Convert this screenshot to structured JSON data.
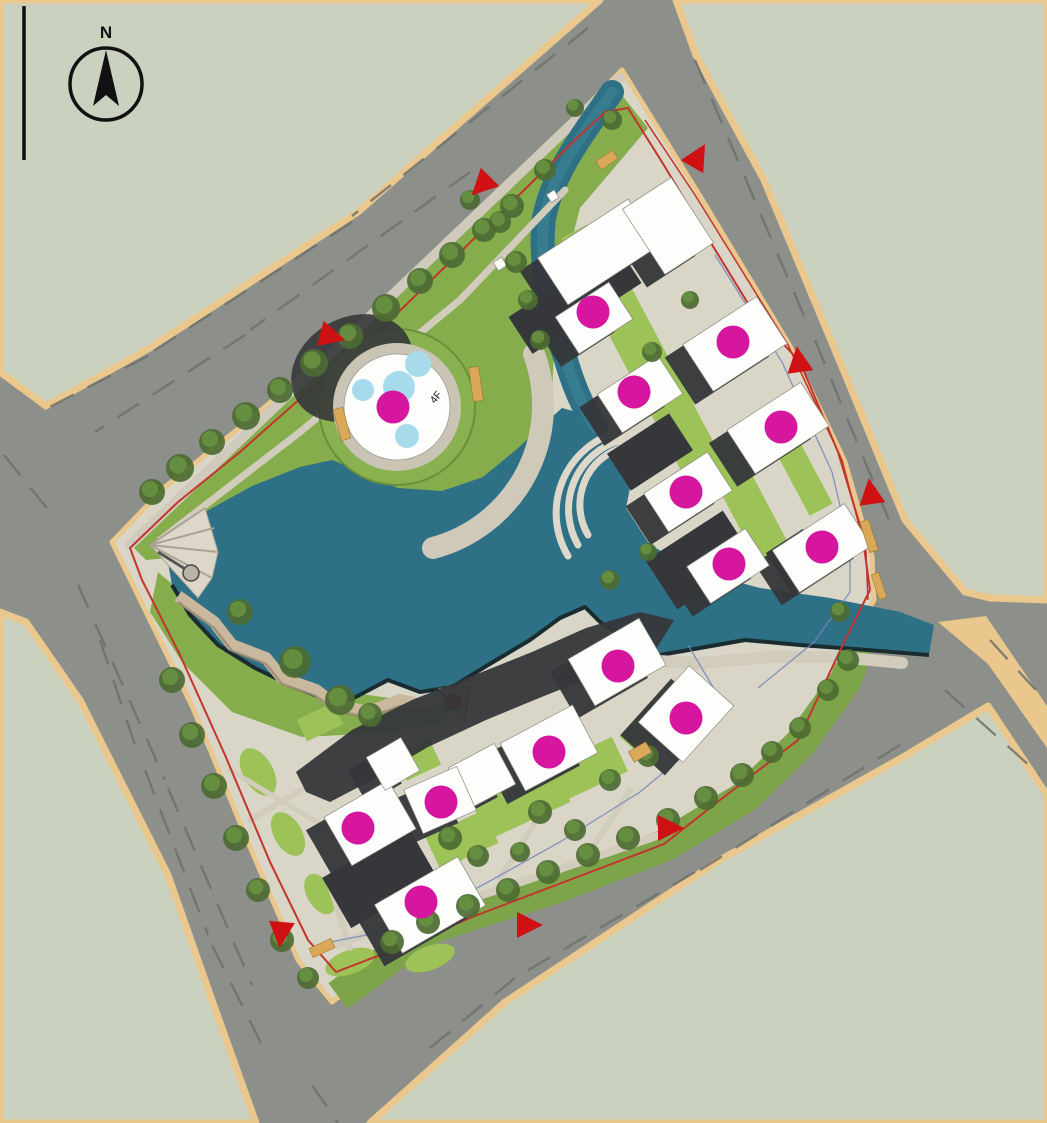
{
  "compass": {
    "label": "N"
  },
  "plaza": {
    "floor_label": "4F",
    "cx": 397,
    "cy": 407,
    "pools": [
      {
        "x": 418,
        "y": 364,
        "r": 13
      },
      {
        "x": 399,
        "y": 387,
        "r": 16
      },
      {
        "x": 363,
        "y": 390,
        "r": 11
      },
      {
        "x": 407,
        "y": 436,
        "r": 12
      }
    ]
  },
  "colors": {
    "road": "#8d8f8a",
    "road_dash": "#6e716c",
    "block": "#cbd1bf",
    "block_edge": "#e9c78d",
    "pavement": "#d9d5c7",
    "lawn": "#86ad4c",
    "lawn_light": "#9cc258",
    "lawn_band": "#7ea449",
    "tree_dark": "#4c6b33",
    "tree_mid": "#678f40",
    "lake": "#2e7086",
    "lake_edge": "#1b2c31",
    "pool": "#a7dbeb",
    "white": "#fdfdfb",
    "shadow": "#35373a",
    "magenta": "#d6169e",
    "red": "#cf1113",
    "red_line": "#c2342c",
    "blue_line": "#7186bb",
    "bench": "#d9a858",
    "terrace": "#c9b79e",
    "deck_red": "#c52020"
  },
  "markers": {
    "residential_units": [
      [
        593,
        312
      ],
      [
        733,
        342
      ],
      [
        634,
        392
      ],
      [
        781,
        427
      ],
      [
        686,
        492
      ],
      [
        729,
        564
      ],
      [
        822,
        547
      ],
      [
        393,
        407
      ],
      [
        618,
        666
      ],
      [
        686,
        718
      ],
      [
        549,
        752
      ],
      [
        441,
        802
      ],
      [
        358,
        828
      ],
      [
        421,
        902
      ]
    ],
    "entrances": [
      {
        "x": 483,
        "y": 184,
        "rot": 225
      },
      {
        "x": 697,
        "y": 158,
        "rot": 30
      },
      {
        "x": 330,
        "y": 336,
        "rot": 105
      },
      {
        "x": 799,
        "y": 362,
        "rot": -8
      },
      {
        "x": 871,
        "y": 494,
        "rot": -8
      },
      {
        "x": 668,
        "y": 828,
        "rot": 90
      },
      {
        "x": 527,
        "y": 925,
        "rot": 90
      },
      {
        "x": 281,
        "y": 932,
        "rot": 185
      }
    ]
  },
  "buildings": [
    [
      575,
      300,
      130,
      44,
      -33,
      "dark"
    ],
    [
      650,
      452,
      74,
      44,
      -33,
      "dark"
    ],
    [
      700,
      560,
      92,
      58,
      -33,
      "dark"
    ],
    [
      798,
      562,
      44,
      50,
      -33,
      "dark"
    ],
    [
      598,
      252,
      108,
      56,
      -33,
      "white"
    ],
    [
      668,
      226,
      58,
      78,
      -33,
      "white"
    ],
    [
      594,
      318,
      64,
      44,
      -33,
      "white"
    ],
    [
      735,
      344,
      88,
      56,
      -33,
      "white"
    ],
    [
      640,
      394,
      72,
      46,
      -33,
      "white"
    ],
    [
      778,
      428,
      88,
      52,
      -33,
      "white"
    ],
    [
      688,
      492,
      76,
      46,
      -33,
      "white"
    ],
    [
      822,
      548,
      86,
      50,
      -33,
      "white"
    ],
    [
      728,
      566,
      70,
      44,
      -33,
      "white"
    ],
    [
      380,
      878,
      100,
      58,
      -30,
      "dark"
    ],
    [
      617,
      662,
      82,
      54,
      -30,
      "white"
    ],
    [
      686,
      714,
      76,
      60,
      -48,
      "white"
    ],
    [
      549,
      748,
      82,
      54,
      -28,
      "white"
    ],
    [
      482,
      776,
      52,
      46,
      -28,
      "white"
    ],
    [
      440,
      800,
      58,
      48,
      -24,
      "white"
    ],
    [
      370,
      823,
      74,
      56,
      -30,
      "white"
    ],
    [
      393,
      764,
      40,
      38,
      -30,
      "white"
    ],
    [
      430,
      905,
      96,
      56,
      -30,
      "white"
    ]
  ],
  "trees": [
    [
      152,
      492,
      13
    ],
    [
      180,
      468,
      14
    ],
    [
      212,
      442,
      13
    ],
    [
      246,
      416,
      14
    ],
    [
      280,
      390,
      13
    ],
    [
      314,
      363,
      14
    ],
    [
      350,
      336,
      13
    ],
    [
      386,
      308,
      14
    ],
    [
      420,
      281,
      13
    ],
    [
      452,
      255,
      13
    ],
    [
      484,
      230,
      12
    ],
    [
      512,
      206,
      12
    ],
    [
      470,
      200,
      10
    ],
    [
      545,
      170,
      11
    ],
    [
      500,
      222,
      11
    ],
    [
      516,
      262,
      11
    ],
    [
      528,
      300,
      10
    ],
    [
      540,
      340,
      10
    ],
    [
      295,
      662,
      16
    ],
    [
      340,
      700,
      15
    ],
    [
      240,
      612,
      13
    ],
    [
      370,
      715,
      12
    ],
    [
      172,
      680,
      13
    ],
    [
      192,
      735,
      13
    ],
    [
      214,
      786,
      13
    ],
    [
      236,
      838,
      13
    ],
    [
      258,
      890,
      12
    ],
    [
      282,
      940,
      12
    ],
    [
      308,
      978,
      11
    ],
    [
      392,
      942,
      12
    ],
    [
      428,
      922,
      12
    ],
    [
      468,
      906,
      12
    ],
    [
      508,
      890,
      12
    ],
    [
      548,
      872,
      12
    ],
    [
      588,
      855,
      12
    ],
    [
      628,
      838,
      12
    ],
    [
      668,
      820,
      12
    ],
    [
      706,
      798,
      12
    ],
    [
      742,
      775,
      12
    ],
    [
      772,
      752,
      11
    ],
    [
      800,
      728,
      11
    ],
    [
      828,
      690,
      11
    ],
    [
      848,
      660,
      11
    ],
    [
      450,
      838,
      12
    ],
    [
      478,
      856,
      11
    ],
    [
      540,
      812,
      12
    ],
    [
      575,
      830,
      11
    ],
    [
      610,
      780,
      11
    ],
    [
      648,
      756,
      11
    ],
    [
      520,
      852,
      10
    ],
    [
      652,
      352,
      10
    ],
    [
      690,
      300,
      9
    ],
    [
      610,
      580,
      10
    ],
    [
      648,
      552,
      9
    ],
    [
      840,
      612,
      10
    ],
    [
      612,
      120,
      10
    ],
    [
      575,
      108,
      9
    ]
  ],
  "benches": [
    [
      607,
      160,
      20,
      10,
      -34
    ],
    [
      476,
      384,
      10,
      34,
      -8
    ],
    [
      869,
      536,
      9,
      32,
      -18
    ],
    [
      879,
      586,
      8,
      26,
      -18
    ],
    [
      322,
      948,
      24,
      10,
      -25
    ],
    [
      640,
      752,
      20,
      12,
      -30
    ],
    [
      342,
      424,
      10,
      32,
      -15
    ]
  ]
}
